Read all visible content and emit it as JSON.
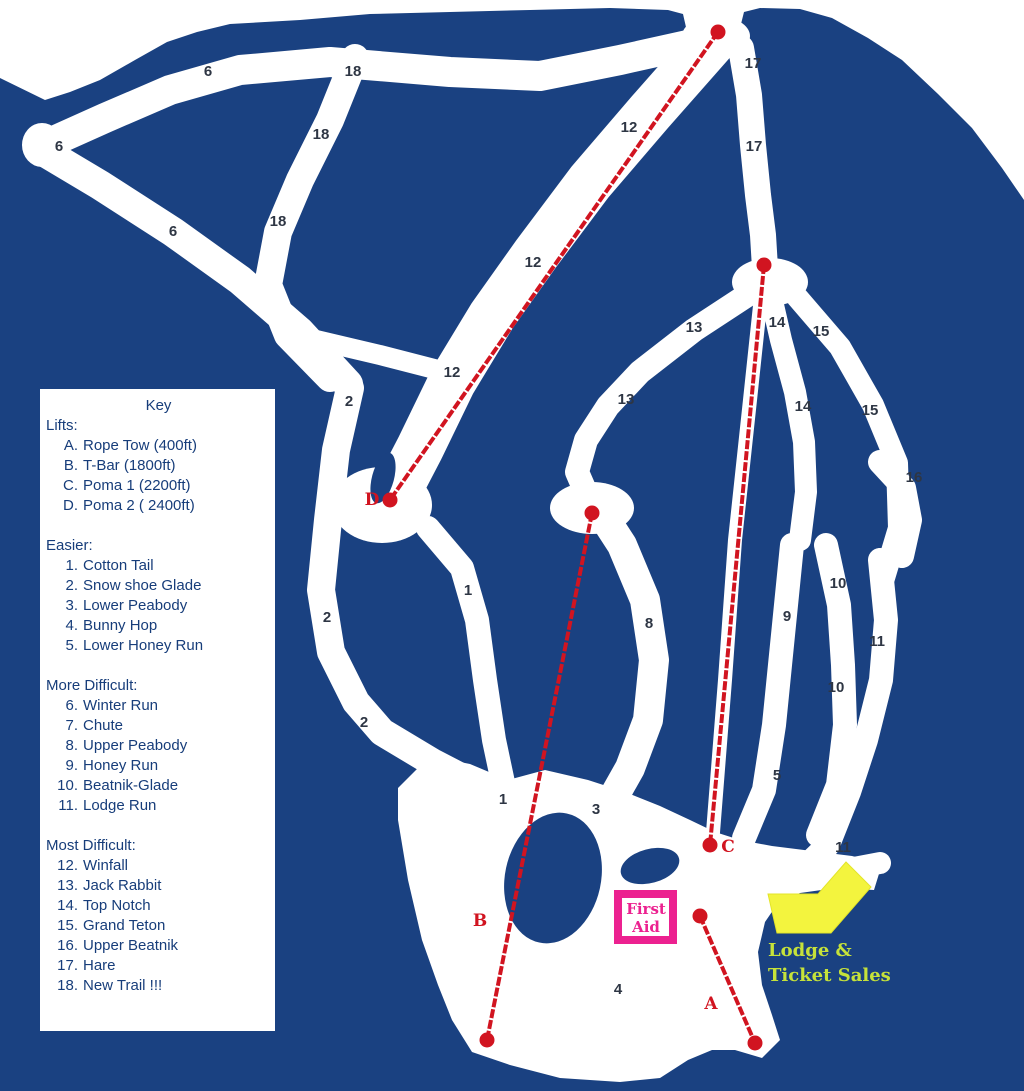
{
  "colors": {
    "mountain": "#1a4181",
    "trail": "#ffffff",
    "lift_red": "#d11420",
    "trail_label": "#2e3644",
    "key_text": "#173d7a",
    "first_aid_pink": "#ec2190",
    "lodge_arrow_yellow": "#f3f43e",
    "lodge_text_yellow_green": "#c6e23a"
  },
  "key": {
    "title": "Key",
    "sections": [
      {
        "heading": "Lifts:",
        "items": [
          {
            "n": "A.",
            "label": "Rope Tow (400ft)"
          },
          {
            "n": "B.",
            "label": "T-Bar (1800ft)"
          },
          {
            "n": "C.",
            "label": "Poma 1 (2200ft)"
          },
          {
            "n": "D.",
            "label": "Poma 2 ( 2400ft)"
          }
        ]
      },
      {
        "heading": "Easier:",
        "items": [
          {
            "n": "1.",
            "label": "Cotton Tail"
          },
          {
            "n": "2.",
            "label": "Snow shoe Glade"
          },
          {
            "n": "3.",
            "label": "Lower Peabody"
          },
          {
            "n": "4.",
            "label": "Bunny Hop"
          },
          {
            "n": "5.",
            "label": "Lower Honey Run"
          }
        ]
      },
      {
        "heading": "More Difficult:",
        "items": [
          {
            "n": "6.",
            "label": "Winter Run"
          },
          {
            "n": "7.",
            "label": "Chute"
          },
          {
            "n": "8.",
            "label": "Upper Peabody"
          },
          {
            "n": "9.",
            "label": "Honey Run"
          },
          {
            "n": "10.",
            "label": "Beatnik-Glade"
          },
          {
            "n": "11.",
            "label": "Lodge Run"
          }
        ]
      },
      {
        "heading": "Most Difficult:",
        "items": [
          {
            "n": "12.",
            "label": "Winfall"
          },
          {
            "n": "13.",
            "label": "Jack Rabbit"
          },
          {
            "n": "14.",
            "label": "Top Notch"
          },
          {
            "n": "15.",
            "label": "Grand Teton"
          },
          {
            "n": "16.",
            "label": "Upper Beatnik"
          },
          {
            "n": "17.",
            "label": "Hare"
          },
          {
            "n": "18.",
            "label": "New Trail !!!"
          }
        ]
      }
    ]
  },
  "map": {
    "trail_labels": [
      {
        "t": "6",
        "x": 208,
        "y": 71
      },
      {
        "t": "6",
        "x": 59,
        "y": 146
      },
      {
        "t": "6",
        "x": 173,
        "y": 231
      },
      {
        "t": "18",
        "x": 353,
        "y": 71
      },
      {
        "t": "18",
        "x": 321,
        "y": 134
      },
      {
        "t": "18",
        "x": 278,
        "y": 221
      },
      {
        "t": "12",
        "x": 629,
        "y": 127
      },
      {
        "t": "12",
        "x": 533,
        "y": 262
      },
      {
        "t": "12",
        "x": 452,
        "y": 372
      },
      {
        "t": "17",
        "x": 753,
        "y": 63
      },
      {
        "t": "17",
        "x": 754,
        "y": 146
      },
      {
        "t": "13",
        "x": 694,
        "y": 327
      },
      {
        "t": "13",
        "x": 626,
        "y": 399
      },
      {
        "t": "14",
        "x": 777,
        "y": 322
      },
      {
        "t": "14",
        "x": 803,
        "y": 406
      },
      {
        "t": "15",
        "x": 821,
        "y": 331
      },
      {
        "t": "15",
        "x": 870,
        "y": 410
      },
      {
        "t": "16",
        "x": 914,
        "y": 477
      },
      {
        "t": "2",
        "x": 349,
        "y": 401
      },
      {
        "t": "2",
        "x": 327,
        "y": 617
      },
      {
        "t": "2",
        "x": 364,
        "y": 722
      },
      {
        "t": "1",
        "x": 468,
        "y": 590
      },
      {
        "t": "1",
        "x": 503,
        "y": 799
      },
      {
        "t": "8",
        "x": 649,
        "y": 623
      },
      {
        "t": "9",
        "x": 787,
        "y": 616
      },
      {
        "t": "10",
        "x": 838,
        "y": 583
      },
      {
        "t": "10",
        "x": 836,
        "y": 687
      },
      {
        "t": "11",
        "x": 877,
        "y": 641
      },
      {
        "t": "11",
        "x": 843,
        "y": 847
      },
      {
        "t": "5",
        "x": 777,
        "y": 775
      },
      {
        "t": "3",
        "x": 596,
        "y": 809
      },
      {
        "t": "4",
        "x": 618,
        "y": 989
      }
    ],
    "lifts": [
      {
        "id": "D",
        "x1": 718,
        "y1": 32,
        "x2": 390,
        "y2": 500,
        "lx": 372,
        "ly": 499
      },
      {
        "id": "C",
        "x1": 764,
        "y1": 265,
        "x2": 710,
        "y2": 845,
        "lx": 728,
        "ly": 846
      },
      {
        "id": "B",
        "x1": 592,
        "y1": 513,
        "x2": 487,
        "y2": 1040,
        "lx": 480,
        "ly": 920
      },
      {
        "id": "A",
        "x1": 700,
        "y1": 916,
        "x2": 755,
        "y2": 1043,
        "lx": 711,
        "ly": 1003
      }
    ],
    "first_aid": {
      "lines": [
        "First",
        "Aid"
      ]
    },
    "lodge": {
      "lines": [
        "Lodge &",
        "Ticket Sales"
      ]
    }
  }
}
